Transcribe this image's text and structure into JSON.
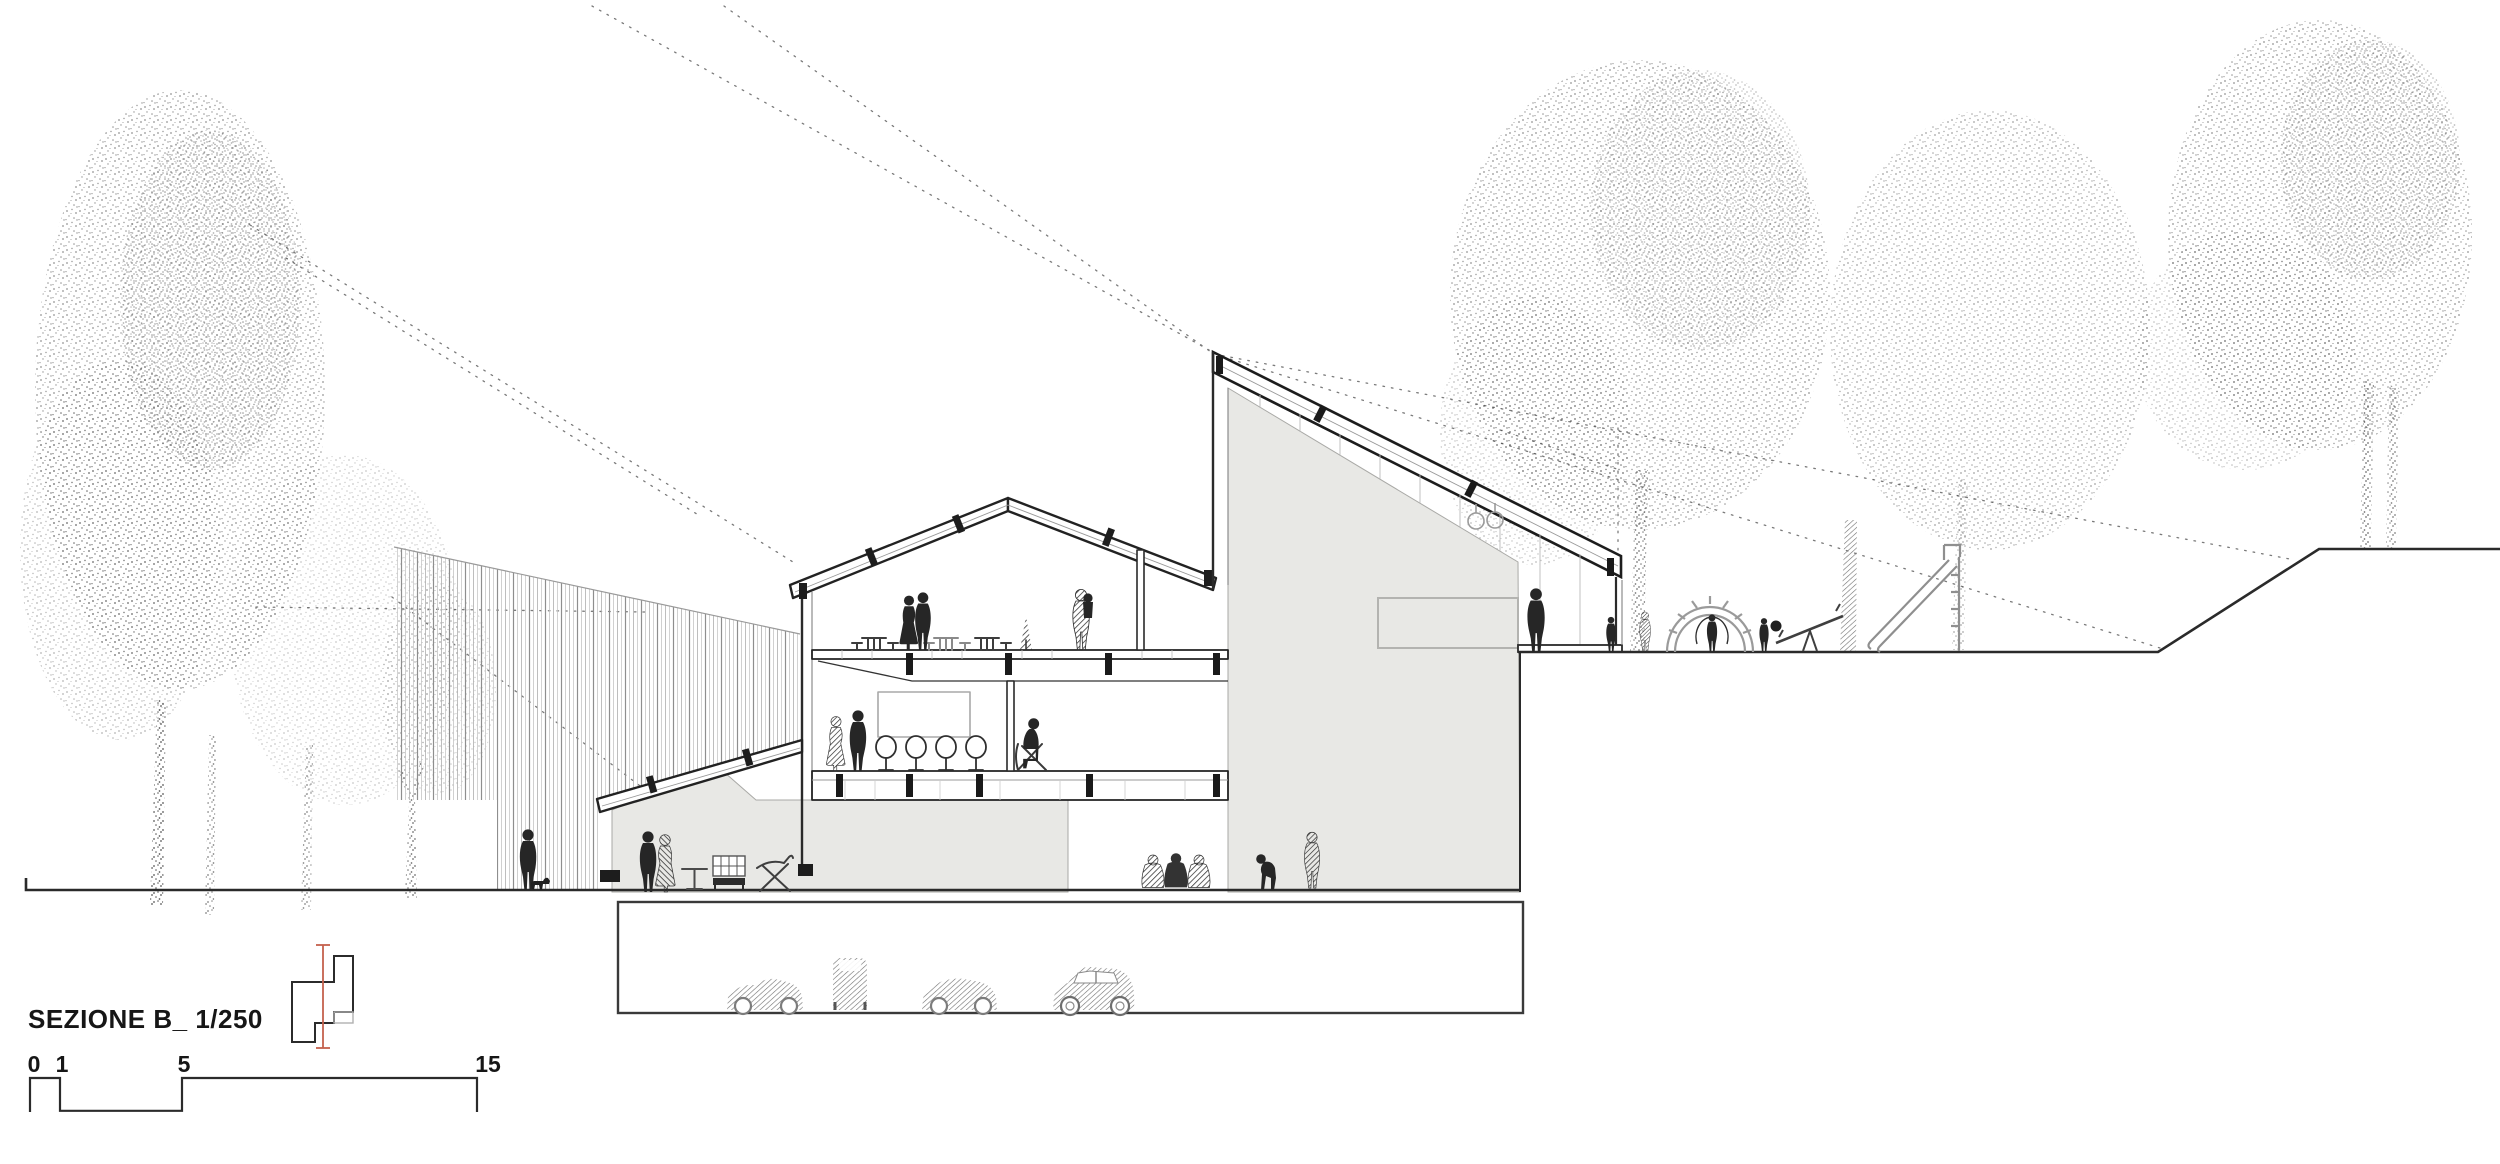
{
  "titleblock": {
    "title": "SEZIONE B_ 1/250"
  },
  "scale_bar": {
    "labels": {
      "t0": "0",
      "t1": "1",
      "t5": "5",
      "t15": "15"
    }
  },
  "key_plan": {
    "description": "stepped floor-plan outline crossed by red section line B"
  },
  "colors": {
    "paper": "#ffffff",
    "wall_gray": "#e8e8e5",
    "line_dark": "#1f1f1f",
    "line_mid": "#8a8a8a",
    "section_red": "#c4614d"
  },
  "scene": {
    "type": "architectural-section-drawing",
    "building": "two-storey gabled pavilion with tall mono-pitch hall, slatted screen wall at left, loggia at right",
    "basement": "underground parking with four cars",
    "site_right": "playground with arch climber, seesaw and slide on terraced ground",
    "site_left": "stippled trees and screen wall at lower ground level"
  }
}
